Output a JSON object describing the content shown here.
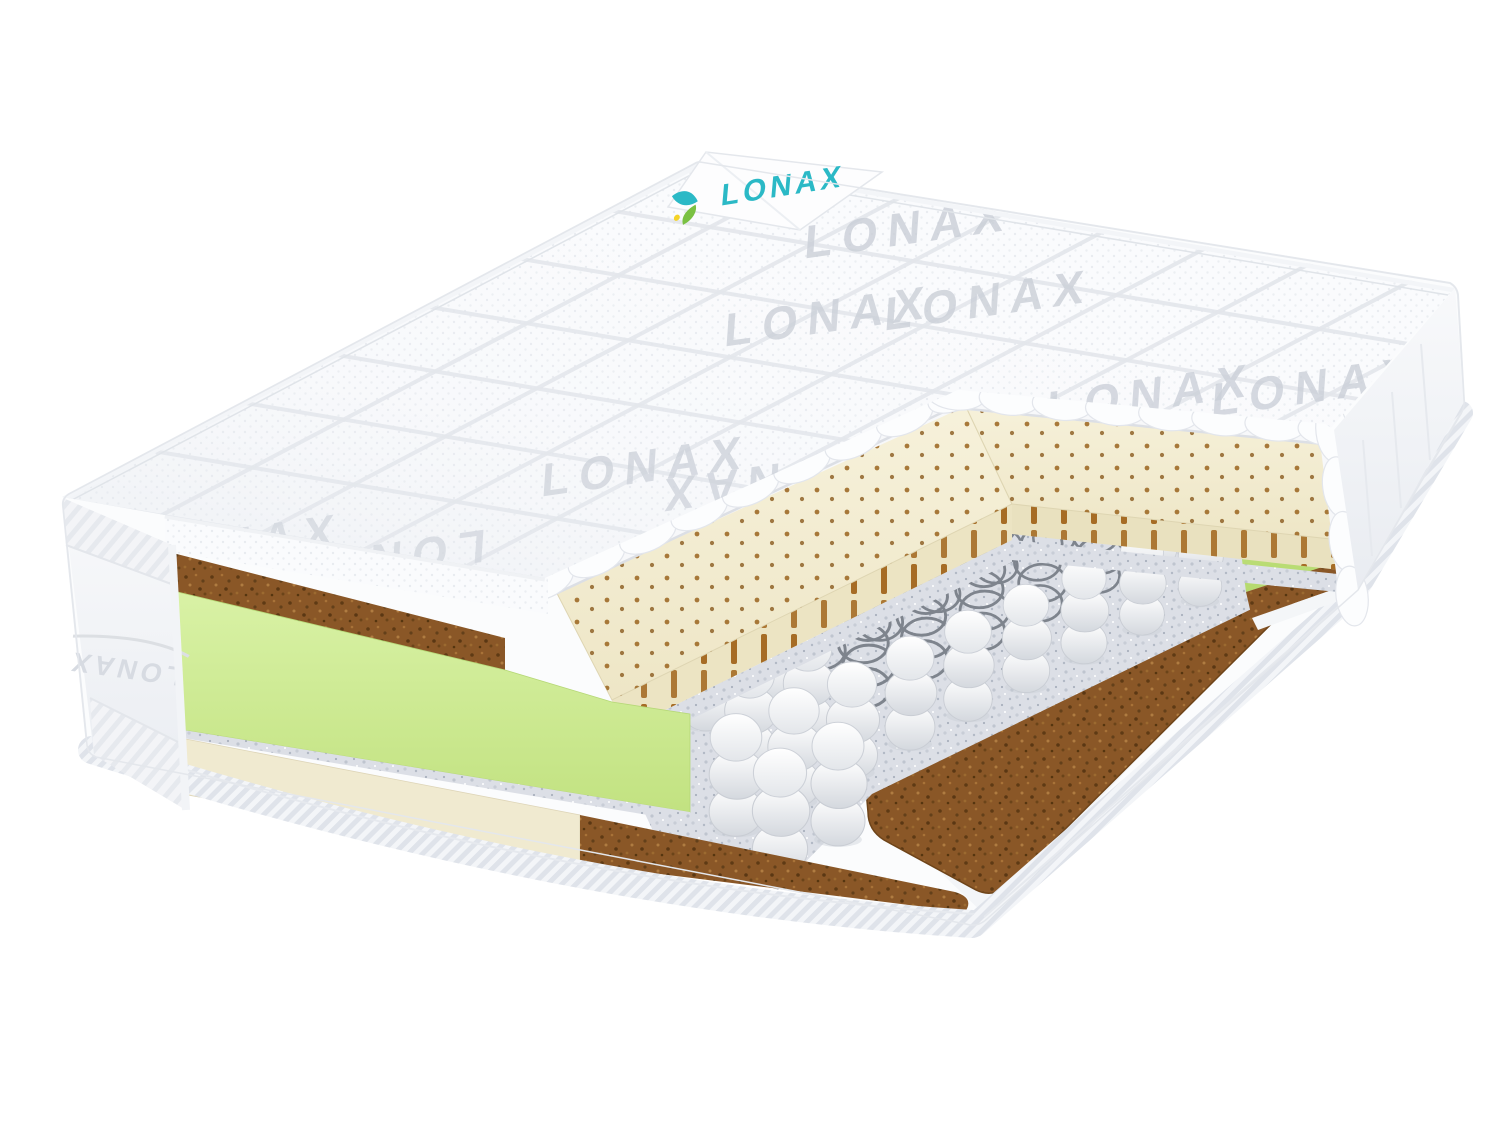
{
  "image": {
    "type": "product-render",
    "subject": "pocket-spring mattress cutaway",
    "background": "#ffffff",
    "width": 1500,
    "height": 1125
  },
  "brand": {
    "name": "LONAX",
    "tag_text": "LONAX",
    "tag_text_color": "#2bb9c6",
    "leaf_colors": [
      "#2bb9c6",
      "#7ac143",
      "#f5d327"
    ]
  },
  "watermarks": {
    "top_cover_text": "LONAX",
    "left_border_text": "LONAX",
    "right_border_script": "Lonax",
    "color": "#c6cbd4"
  },
  "layers": [
    {
      "name": "quilted-knit-cover",
      "color": "#fafbfd"
    },
    {
      "name": "coir-top-strip",
      "color": "#8c5a28"
    },
    {
      "name": "green-foam-layer",
      "color": "#cdec92"
    },
    {
      "name": "felt-pad",
      "color": "#dcdfe6"
    },
    {
      "name": "perforated-latex-layer",
      "color": "#f4efd6",
      "perforation_color": "#9a641f"
    },
    {
      "name": "independent-pocket-springs",
      "color": "#f2f3f6"
    },
    {
      "name": "bare-spring-coils",
      "color": "#7e848d"
    },
    {
      "name": "coir-base-plank",
      "color": "#8a5727"
    },
    {
      "name": "cream-latex-strip",
      "color": "#f0ead0"
    },
    {
      "name": "bottom-cover-tape",
      "color": "#f2f4f7"
    }
  ]
}
